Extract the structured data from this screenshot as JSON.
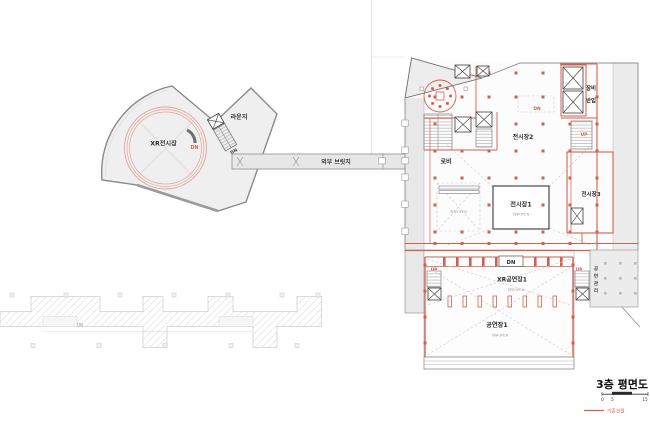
{
  "colors": {
    "accent_red": "#d2604f",
    "ring_red": "#e8a198"
  },
  "left_wing": {
    "xr_hall_label": "XR전시장",
    "xr_dn": "DN",
    "lounge_label": "라운지",
    "lounge_dn": "DN"
  },
  "bridge": {
    "label": "외부 브릿지"
  },
  "main_building": {
    "lobby": "로비",
    "hall2": "전시장2",
    "hall3": "전시장3",
    "hall1": "전시장1",
    "hall1_open": "하부OPEN",
    "left_void_open": "하부OPEN",
    "equipment_line1": "장비",
    "equipment_line2": "반입",
    "dn_mid": "DN",
    "up_hall3": "UP",
    "stage_dn": "DN",
    "xr_performance": "XR공연장1",
    "xr_performance_open": "하부OPEN",
    "performance1": "공연장1",
    "performance1_open": "하부OPEN",
    "up_left": "UP",
    "up_right": "UP",
    "performance_mgmt": "공연관리"
  },
  "existing_building": {
    "dn": "DN"
  },
  "title_block": {
    "title": "3층 평면도",
    "scale_ticks": [
      "0",
      "5",
      "15"
    ],
    "legend_existing": "기존건물"
  }
}
